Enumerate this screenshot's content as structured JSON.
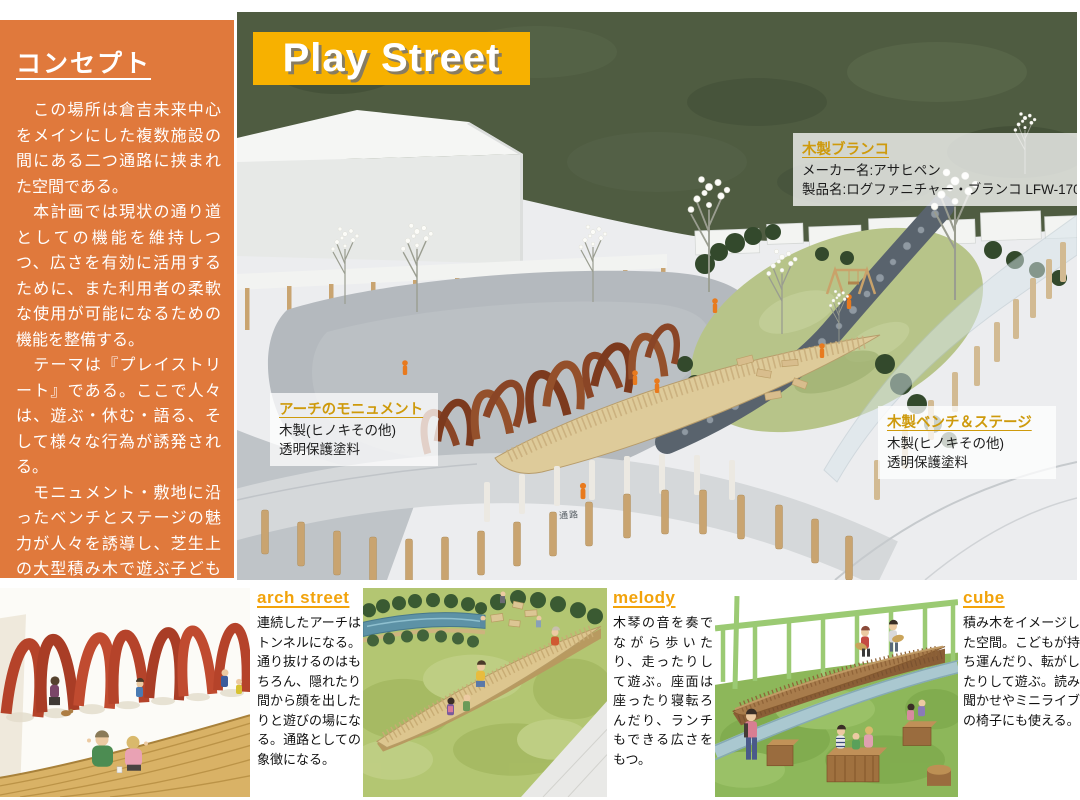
{
  "sidebar": {
    "title": "コンセプト",
    "paragraphs": [
      "　この場所は倉吉未来中心をメインにした複数施設の間にある二つ通路に挟まれた空間である。",
      "　本計画では現状の通り道としての機能を維持しつつ、広さを有効に活用するために、また利用者の柔軟な使用が可能になるための機能を整備する。",
      "　テーマは『プレイストリート』である。ここで人々は、遊ぶ・休む・語る、そして様々な行為が誘発される。",
      "　モニュメント・敷地に沿ったベンチとステージの魅力が人々を誘導し、芝生上の大型積み木で遊ぶ子ども達の見守りやステージの鑑賞もできる。",
      "　思わずくぐりたくなるアーチ状のモニュメントは、通路としての象徴である。",
      "ここは新しいパークスクエアの「映えスポット」になる。"
    ]
  },
  "photo": {
    "title": "Play Street",
    "passage_label": "通路",
    "annotations": {
      "swing": {
        "title": "木製ブランコ",
        "lines": [
          "メーカー名:アサヒペン",
          "製品名:ログファニチャー・ブランコ LFW-170"
        ]
      },
      "arch": {
        "title": "アーチのモニュメント",
        "lines": [
          "木製(ヒノキその他)",
          "透明保護塗料"
        ]
      },
      "bench": {
        "title": "木製ベンチ＆ステージ",
        "lines": [
          "木製(ヒノキその他)",
          "透明保護塗料"
        ]
      }
    }
  },
  "panels": [
    {
      "title": "arch street",
      "text": "連続したアーチはトンネルになる。通り抜けるのはもちろん、隠れたり間から顔を出したりと遊びの場になる。通路としての象徴になる。"
    },
    {
      "title": "melody",
      "text": "木琴の音を奏でながら歩いたり、走ったりして遊ぶ。座面は座ったり寝転ろんだり、ランチもできる広さをもつ。"
    },
    {
      "title": "cube",
      "text": "積み木をイメージした空間。こどもが持ち運んだり、転がしたりして遊ぶ。読み聞かせやミニライブの椅子にも使える。"
    }
  ],
  "colors": {
    "sidebar_bg": "#E0793C",
    "banner_bg": "#F7B100",
    "annotation_accent": "#CE9A0C",
    "panel_accent": "#F2A30B"
  }
}
